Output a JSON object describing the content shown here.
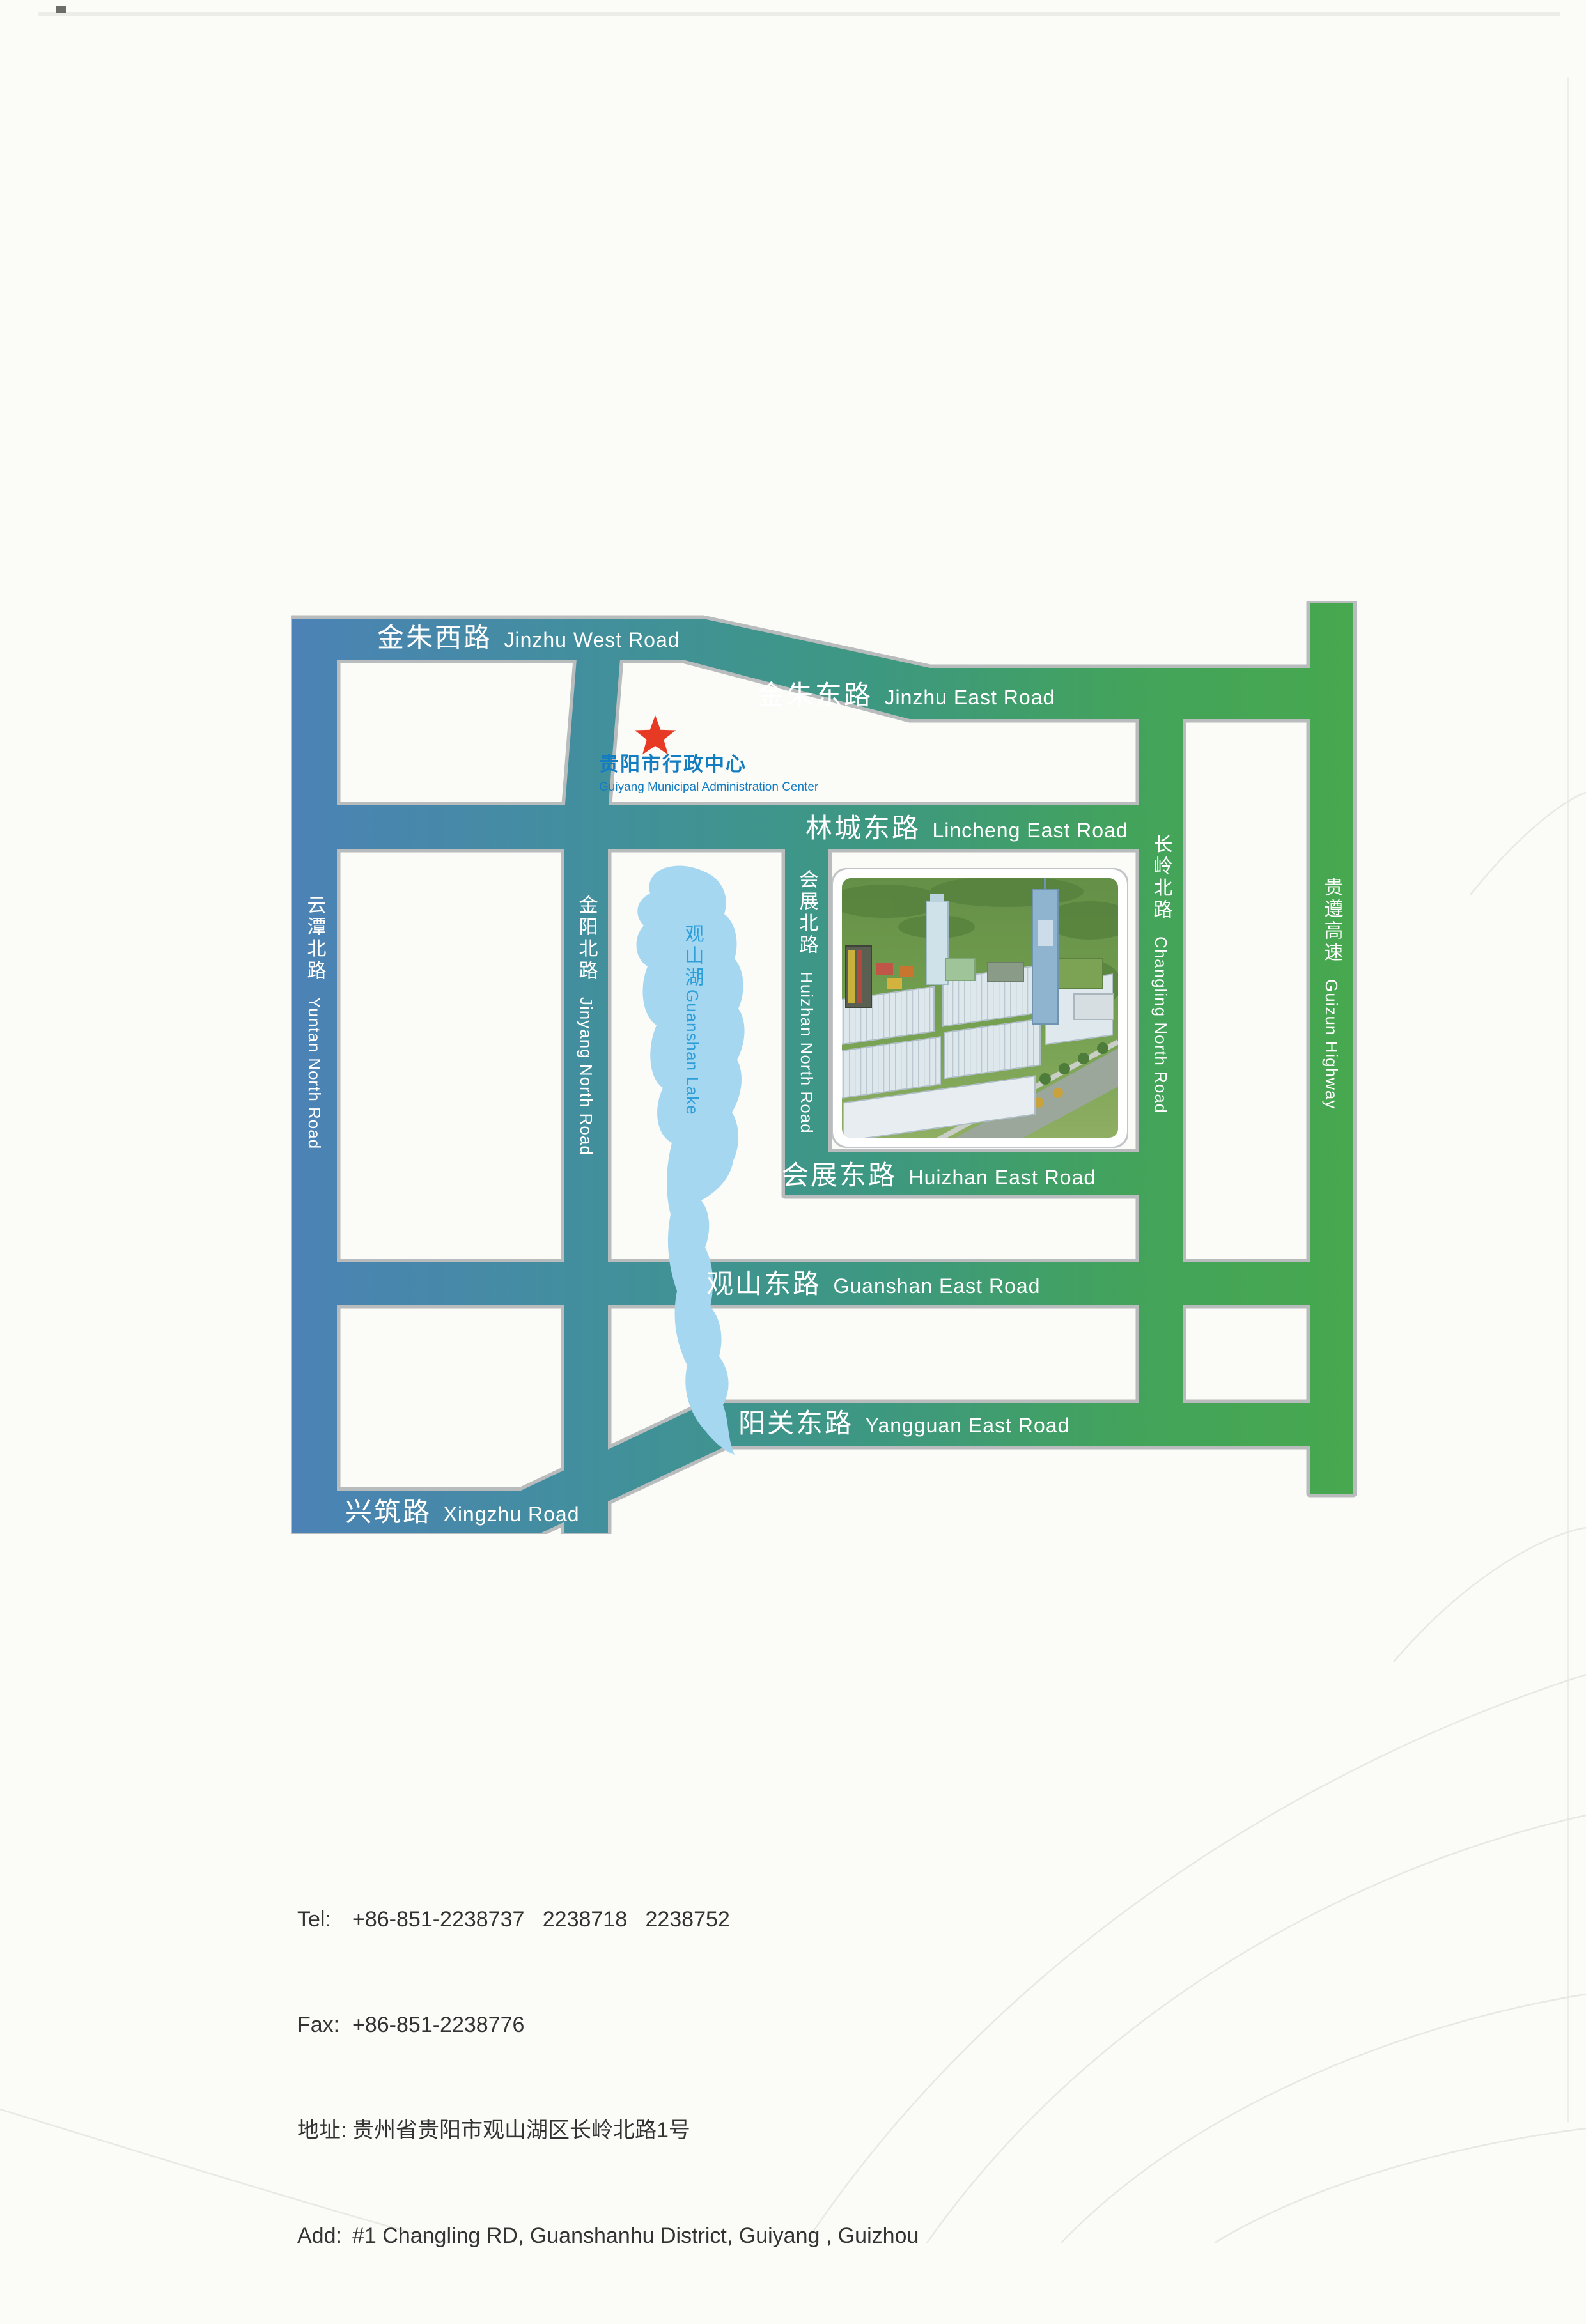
{
  "map": {
    "marker_icon": "red-star",
    "landmark": {
      "zh": "贵阳市行政中心",
      "en": "Guiyang Municipal Administration Center"
    },
    "lake": {
      "zh": "观山湖",
      "en": "Guanshan Lake"
    },
    "roads": {
      "jinzhu_west": {
        "zh": "金朱西路",
        "en": "Jinzhu West Road"
      },
      "jinzhu_east": {
        "zh": "金朱东路",
        "en": "Jinzhu East Road"
      },
      "lincheng_east": {
        "zh": "林城东路",
        "en": "Lincheng East Road"
      },
      "huizhan_east": {
        "zh": "会展东路",
        "en": "Huizhan East Road"
      },
      "guanshan_east": {
        "zh": "观山东路",
        "en": "Guanshan East Road"
      },
      "yangguan_east": {
        "zh": "阳关东路",
        "en": "Yangguan East Road"
      },
      "xingzhu": {
        "zh": "兴筑路",
        "en": "Xingzhu Road"
      },
      "yuntan_north": {
        "zh": "云潭北路",
        "en": "Yuntan North Road"
      },
      "jinyang_north": {
        "zh": "金阳北路",
        "en": "Jinyang North Road"
      },
      "huizhan_north": {
        "zh": "会展北路",
        "en": "Huizhan North Road"
      },
      "changling_north": {
        "zh": "长岭北路",
        "en": "Changling North Road"
      },
      "guizun_highway": {
        "zh": "贵遵高速",
        "en": "Guizun Highway"
      }
    },
    "colors": {
      "road_blue": "#4c82b6",
      "road_teal": "#3d9488",
      "road_green": "#47a84e",
      "road_border": "#b9bcbd",
      "lake_fill": "#a6d7f1",
      "lake_text": "#2e9fd8",
      "landmark_text": "#147dc2",
      "star_red": "#e63a24"
    }
  },
  "contact": {
    "lines": [
      {
        "label": "Tel:",
        "value": "+86-851-2238737   2238718   2238752"
      },
      {
        "label": "Fax:",
        "value": "+86-851-2238776"
      },
      {
        "label": "地址:",
        "value": "贵州省贵阳市观山湖区长岭北路1号"
      },
      {
        "label": "Add:",
        "value": "#1 Changling RD, Guanshanhu District, Guiyang , Guizhou"
      }
    ]
  }
}
